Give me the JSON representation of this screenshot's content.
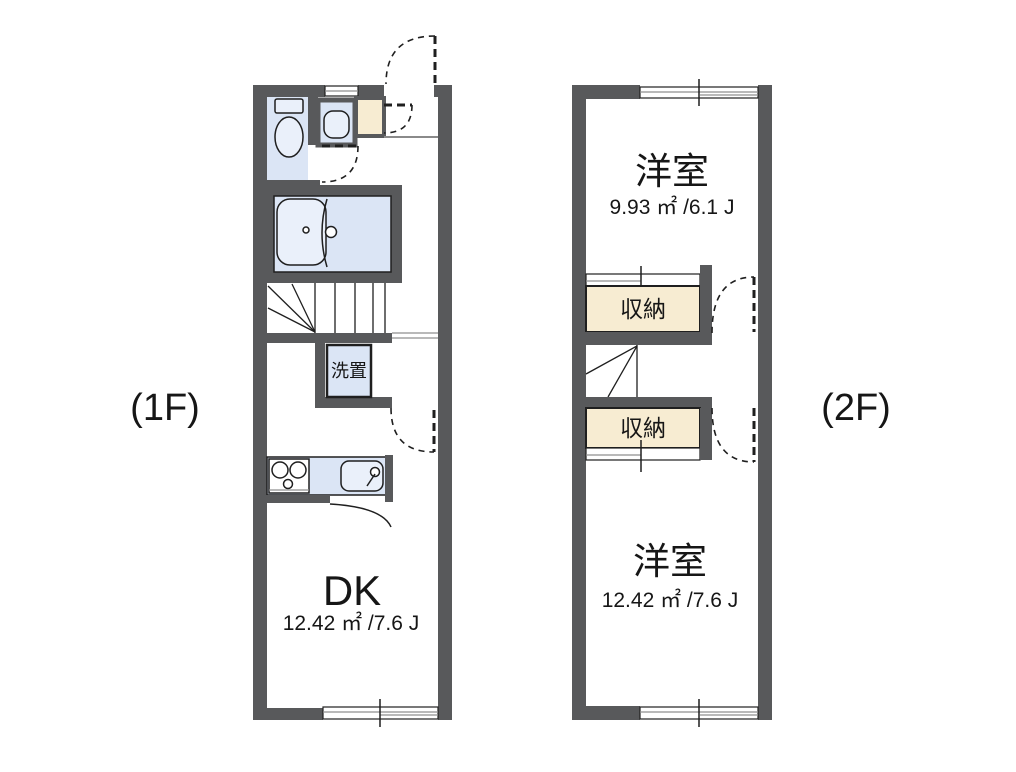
{
  "floor1": {
    "label": "(1F)",
    "dk": {
      "name": "DK",
      "area": "12.42 ㎡ /7.6 J"
    },
    "washer": {
      "label": "洗置"
    }
  },
  "floor2": {
    "label": "(2F)",
    "room_upper": {
      "name": "洋室",
      "area": "9.93 ㎡ /6.1 J"
    },
    "closet_upper": {
      "label": "収納"
    },
    "closet_lower": {
      "label": "収納"
    },
    "room_lower": {
      "name": "洋室",
      "area": "12.42 ㎡ /7.6 J"
    }
  },
  "colors": {
    "wall": "#58595b",
    "fixture": "#dbe5f5",
    "fixture-light": "#eaf0fa",
    "closet": "#f7ecd2",
    "line": "#1f1f1f"
  }
}
